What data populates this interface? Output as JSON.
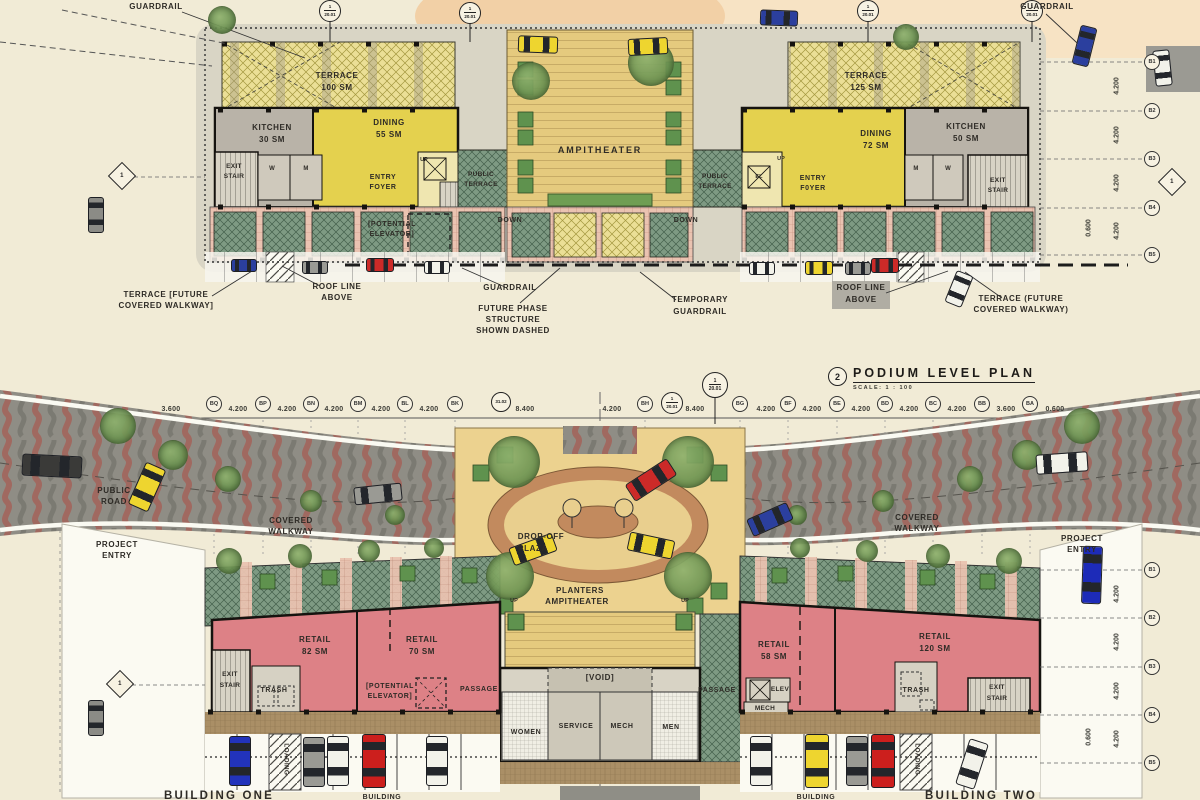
{
  "podium_plan": {
    "callout": {
      "number": "2",
      "title": "PODIUM LEVEL PLAN",
      "scale": "SCALE:  1 : 100"
    },
    "top_labels": {
      "guardrail_left": "GUARDRAIL",
      "guardrail_right": "GUARDRAIL"
    },
    "left_wing": {
      "terrace": "TERRACE",
      "terrace_area": "100 SM",
      "kitchen": "KITCHEN",
      "kitchen_area": "30 SM",
      "dining": "DINING",
      "dining_area": "55 SM",
      "exit": "EXIT",
      "stair": "STAIR",
      "wc_women": "W",
      "wc_men": "M",
      "entry": "ENTRY",
      "foyer": "FOYER",
      "up": "UP",
      "public": "PUBLIC",
      "terrace2": "TERRACE",
      "potential": "[POTENTIAL",
      "elevator": "ELEVATOR]",
      "down": "DOWN"
    },
    "center": {
      "ampitheater": "AMPITHEATER"
    },
    "right_wing": {
      "terrace": "TERRACE",
      "terrace_area": "125 SM",
      "dining": "DINING",
      "dining_area": "72 SM",
      "kitchen": "KITCHEN",
      "kitchen_area": "50 SM",
      "up": "UP",
      "el": "EL",
      "entry": "ENTRY",
      "foyer": "F0YER",
      "wc_men": "M",
      "wc_women": "W",
      "exit": "EXIT",
      "stair": "STAIR",
      "public": "PUBLIC",
      "terrace2": "TERRACE",
      "down": "DOWN"
    },
    "annotations": {
      "terrace_future_left_1": "TERRACE [FUTURE",
      "terrace_future_left_2": "COVERED WALKWAY]",
      "roof_line_1": "ROOF LINE",
      "roof_line_2": "ABOVE",
      "guardrail": "GUARDRAIL",
      "future_phase_1": "FUTURE PHASE",
      "future_phase_2": "STRUCTURE",
      "future_phase_3": "SHOWN DASHED",
      "temporary_1": "TEMPORARY",
      "temporary_2": "GUARDRAIL",
      "roof_line_r1": "ROOF LINE",
      "roof_line_r2": "ABOVE",
      "terrace_future_right_1": "TERRACE (FUTURE",
      "terrace_future_right_2": "COVERED WALKWAY)"
    }
  },
  "grid": {
    "top_row": [
      "BQ",
      "BP",
      "BN",
      "BM",
      "BL",
      "BK",
      "BH",
      "BG",
      "BF",
      "BE",
      "BD",
      "BC",
      "BB",
      "BA"
    ],
    "dims": [
      "3.600",
      "4.200",
      "4.200",
      "4.200",
      "4.200",
      "4.200",
      "8.400",
      "4.200",
      "8.400",
      "4.200",
      "4.200",
      "4.200",
      "4.200",
      "4.200",
      "3.600",
      "0.600"
    ],
    "right_top": [
      "B1",
      "B2",
      "B3",
      "B4",
      "B5"
    ],
    "right_bottom": [
      "B1",
      "B2",
      "B3",
      "B4",
      "B5"
    ],
    "vdim": "4.200",
    "offset": "0.600",
    "ref_num": "1",
    "ref_sheet": "20.01",
    "ref_dome": "31.02",
    "section_num": "1"
  },
  "ground_plan": {
    "site": {
      "public": "PUBLIC",
      "road": "ROAD",
      "project": "PROJECT",
      "entry": "ENTRY",
      "covered": "COVERED",
      "walkway": "WALKWAY"
    },
    "plaza": {
      "drop_off": "DROP-OFF",
      "plaza": "PLAZA",
      "planters": "PLANTERS",
      "ampitheater": "AMPITHEATER",
      "up": "UP",
      "void": "[VOID]"
    },
    "core": {
      "women": "WOMEN",
      "service": "SERVICE",
      "mech": "MECH",
      "men": "MEN",
      "passage": "PASSAGE"
    },
    "building_one": {
      "retail": "RETAIL",
      "retail_a_area": "82 SM",
      "retail_b_area": "70 SM",
      "potential": "[POTENTIAL",
      "elevator": "ELEVATOR]",
      "exit": "EXIT",
      "stair": "STAIR",
      "trash": "TRASH",
      "loading": "LOADING",
      "name": "BUILDING ONE"
    },
    "building_two": {
      "retail": "RETAIL",
      "retail_a_area": "58 SM",
      "retail_b_area": "120 SM",
      "elev": "ELEV",
      "mech": "MECH",
      "trash": "TRASH",
      "exit": "EXIT",
      "stair": "STAIR",
      "loading": "LOADING",
      "name": "BUILDING TWO"
    },
    "building_partial": "BUILDING"
  },
  "colors": {
    "cream": "#f1ebd6",
    "yellow_room": "#e4d14e",
    "yellow_terrace": "#ebdf96",
    "gray_room": "#b9b3a8",
    "teal": "#7e9a83",
    "pink_walkway": "#eac3b1",
    "amphitheater_tan": "#e5ca7e",
    "planter_green": "#5f924e",
    "retail_pink": "#dd8186",
    "road_gray": "#8f8d85",
    "road_stripe": "#a2655c",
    "brick": "#c28a5e",
    "sidewalk": "#aa8f66"
  }
}
